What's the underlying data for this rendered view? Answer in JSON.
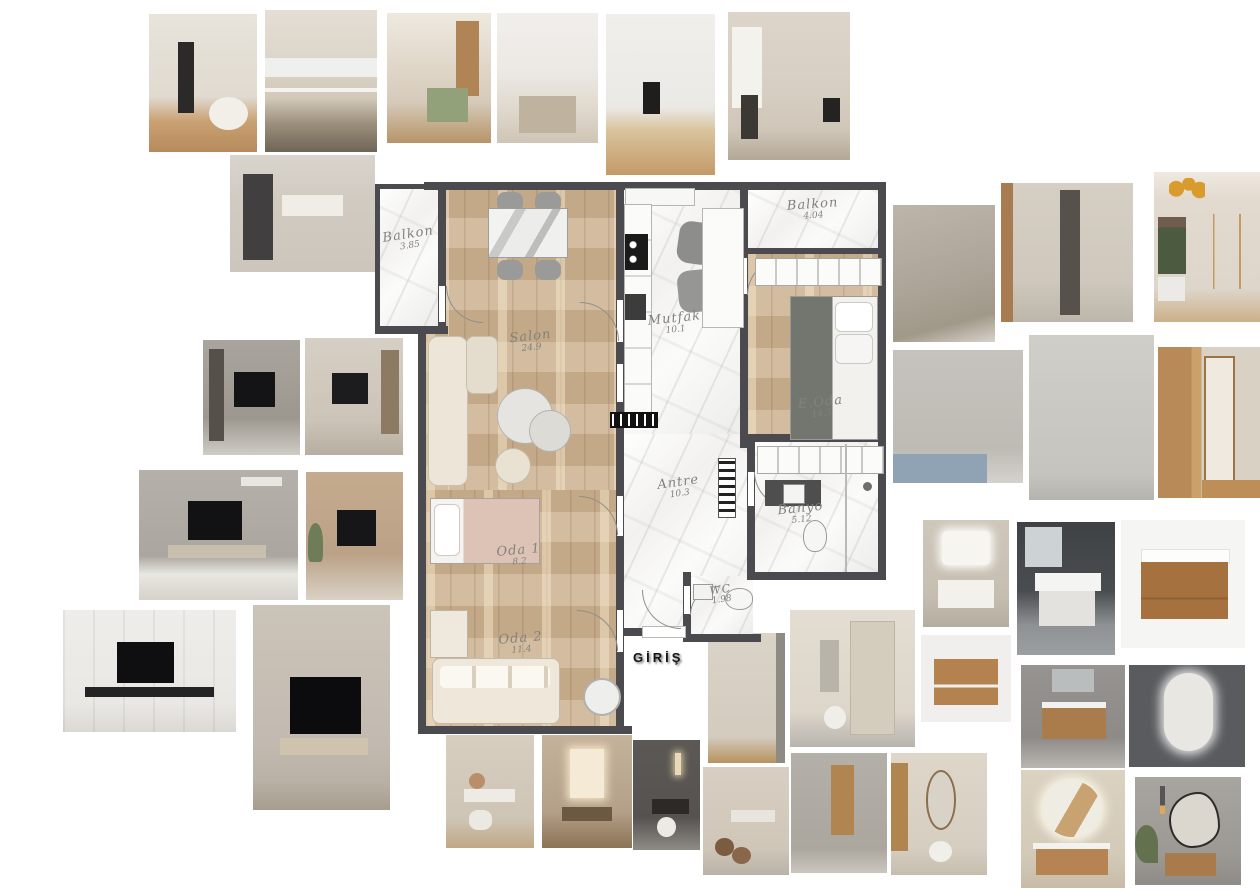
{
  "floor_plan": {
    "entrance_label": "GİRİŞ",
    "colors": {
      "wall": "#4b4b4f",
      "wood_floor": "#c9ae8b",
      "marble_floor": "#f4f3f1"
    },
    "rooms": {
      "balkon1": {
        "label": "Balkon",
        "area": "3.85"
      },
      "salon": {
        "label": "Salon",
        "area": "24.9"
      },
      "mutfak": {
        "label": "Mutfak",
        "area": "10.1"
      },
      "balkon2": {
        "label": "Balkon",
        "area": "4.04"
      },
      "eoda": {
        "label": "E.Oda",
        "area": "14.3"
      },
      "antre": {
        "label": "Antre",
        "area": "10.3"
      },
      "banyo": {
        "label": "Banyo",
        "area": "5.12"
      },
      "oda1": {
        "label": "Oda 1",
        "area": "8.2"
      },
      "oda2": {
        "label": "Oda 2",
        "area": "11.4"
      },
      "wc": {
        "label": "WC",
        "area": "1.98"
      }
    }
  },
  "photos": [
    {
      "name": "kitchen-white-black-oven",
      "desc": "Cream kitchen with black built-in oven column and round dining table"
    },
    {
      "name": "kitchen-beige-counter",
      "desc": "Beige flat-front kitchen with marble backsplash and long counter"
    },
    {
      "name": "kitchen-wood-dining",
      "desc": "Kitchen with oak shelving, green island and dining table"
    },
    {
      "name": "kitchen-marble-island",
      "desc": "White kitchen with marble wall and taupe island"
    },
    {
      "name": "kitchen-white-oven",
      "desc": "White kitchen with black oven and oak floor"
    },
    {
      "name": "kitchen-beige-window",
      "desc": "Greige kitchen with window and dark dining chair"
    },
    {
      "name": "kitchen-dark-fridge",
      "desc": "Kitchen with dark fridge and illuminated marble backsplash"
    },
    {
      "name": "wardrobe-taupe-corridor",
      "desc": "Taupe panelled wardrobe corridor"
    },
    {
      "name": "wardrobe-mirror-cream",
      "desc": "Cream wardrobe wall with mirrored column"
    },
    {
      "name": "bedroom-chandelier",
      "desc": "Bedroom wardrobe with brass chandelier and garden window"
    },
    {
      "name": "tv-wall-marble-shelf",
      "desc": "Dark marble TV wall with shelving column"
    },
    {
      "name": "living-tv-beige",
      "desc": "Beige living room TV wall with bookshelf"
    },
    {
      "name": "tv-wall-gray-long",
      "desc": "Gray marble TV wall with long bench and white rug"
    },
    {
      "name": "bedroom-tv-wood",
      "desc": "Bedroom with wood slat TV wall"
    },
    {
      "name": "tv-wall-classic-white",
      "desc": "Classic white panelled TV wall with floating black console"
    },
    {
      "name": "living-tv-dark-tall",
      "desc": "Living room with large black TV and beige console"
    },
    {
      "name": "wardrobe-gray-bed",
      "desc": "Light gray wardrobe beside bed with blue bedding"
    },
    {
      "name": "wardrobe-tall-gray",
      "desc": "Tall light gray wardrobe doors with slim handles"
    },
    {
      "name": "wardrobe-wood-mirror",
      "desc": "Wood wardrobe with mirror reflecting hallway"
    },
    {
      "name": "vanity-white-backlit",
      "desc": "White vanity with backlit rectangular mirror"
    },
    {
      "name": "vanity-white-darkwall",
      "desc": "White floating vanity with basin on dark wall"
    },
    {
      "name": "vanity-wood-whitetop",
      "desc": "Walnut floating vanity with white basin top"
    },
    {
      "name": "hall-wardrobe-cream-doors",
      "desc": "Cream hallway wardrobe doors with vertical handles"
    },
    {
      "name": "entry-mirror-console",
      "desc": "Entry hall with mirror, console, pouf and tall wardrobe"
    },
    {
      "name": "vanity-wood-shelf",
      "desc": "Oak vanity cabinet with open shelf"
    },
    {
      "name": "vanity-wood-graywall",
      "desc": "Oak vanity with white top on gray wall"
    },
    {
      "name": "mirror-backlit-dark",
      "desc": "Backlit rounded mirror cabinet on dark wall"
    },
    {
      "name": "entry-flowers-console",
      "desc": "Beige entry with white console and flowers"
    },
    {
      "name": "entry-lit-mirror",
      "desc": "Entry with lit mirror and dark wood bench"
    },
    {
      "name": "entry-dark-lamp",
      "desc": "Dark entry nook with wall lamp, console and pouf"
    },
    {
      "name": "entry-beige-stools",
      "desc": "Beige dressing entry with brown stools"
    },
    {
      "name": "corridor-gray-panels",
      "desc": "Gray panelled corridor with wood niche"
    },
    {
      "name": "entry-oval-mirror",
      "desc": "Entry with oval mirror, wood wardrobe and white pouf"
    },
    {
      "name": "bath-round-mirror",
      "desc": "Bathroom with round backlit mirror and wood vanity"
    },
    {
      "name": "bath-organic-mirror",
      "desc": "Bathroom with organic shaped mirror, pendants and plant"
    }
  ]
}
